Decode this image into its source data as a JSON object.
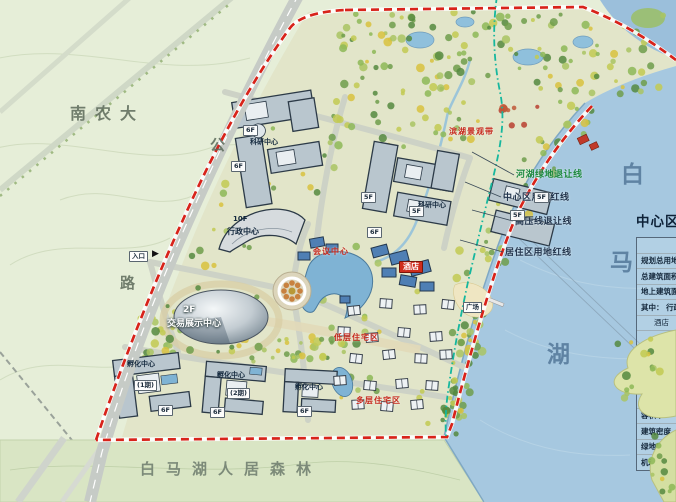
{
  "colors": {
    "boundary_red": "#d8231a",
    "green_setback_line": "#16b79e",
    "lake": "#a6c8e0",
    "farmland": "#e6eed8",
    "site_ground": "#e2e5c9",
    "forest_band": "#d9e5c4",
    "building_fill": "#b9c6ce",
    "building_outline": "#2c3a47",
    "hotel_roof": "#4f7fb4",
    "red_label": "#c6281c"
  },
  "map_labels": {
    "university": "南农大",
    "road_char_top": "公",
    "road_char_bottom": "路",
    "entrance": "入口",
    "entrance_arrow": "▶",
    "admin_center_floors": "10F",
    "admin_center": "行政中心",
    "expo_center_floors": "2F",
    "expo_center": "交易展示中心",
    "research_center_1": "科研中心",
    "research_center_2": "科研中心",
    "hotel": "酒店",
    "conference": "会议中心",
    "lakeside_belt": "滨湖景观带",
    "residential_1": "低层住宅区",
    "residential_2": "多层住宅区",
    "plaza": "广场",
    "incubator_1": "孵化中心",
    "incubator_1_phase": "(1期)",
    "incubator_2": "孵化中心",
    "incubator_2_phase": "(2期)",
    "incubator_3": "孵化中心",
    "forest_band_title": "白马湖人居森林",
    "lake_char_1": "白",
    "lake_char_2": "马",
    "lake_char_3": "湖"
  },
  "floor_tags": [
    "6F",
    "6F",
    "5F",
    "5F",
    "6F",
    "5F",
    "5F",
    "6F",
    "6F",
    "6F"
  ],
  "setback_lines": [
    {
      "text": "河湖绿地退让线",
      "color": "#1f8a3f"
    },
    {
      "text": "中心区用地红线",
      "color": "#24364e"
    },
    {
      "text": "高压线退让线",
      "color": "#24364e"
    },
    {
      "text": "居住区用地红线",
      "color": "#24364e"
    }
  ],
  "legend_table": {
    "title": "中心区经济技术指标",
    "rows": [
      "名称",
      "规划总用地",
      "总建筑面积",
      "地上建筑面积",
      "其中： 行政中心",
      "酒店",
      "交易展示中心",
      "科研中心",
      "配套设施",
      "孵化中心",
      "建筑占地面积",
      "容积率",
      "建筑密度",
      "绿地率",
      "机动车位"
    ]
  }
}
